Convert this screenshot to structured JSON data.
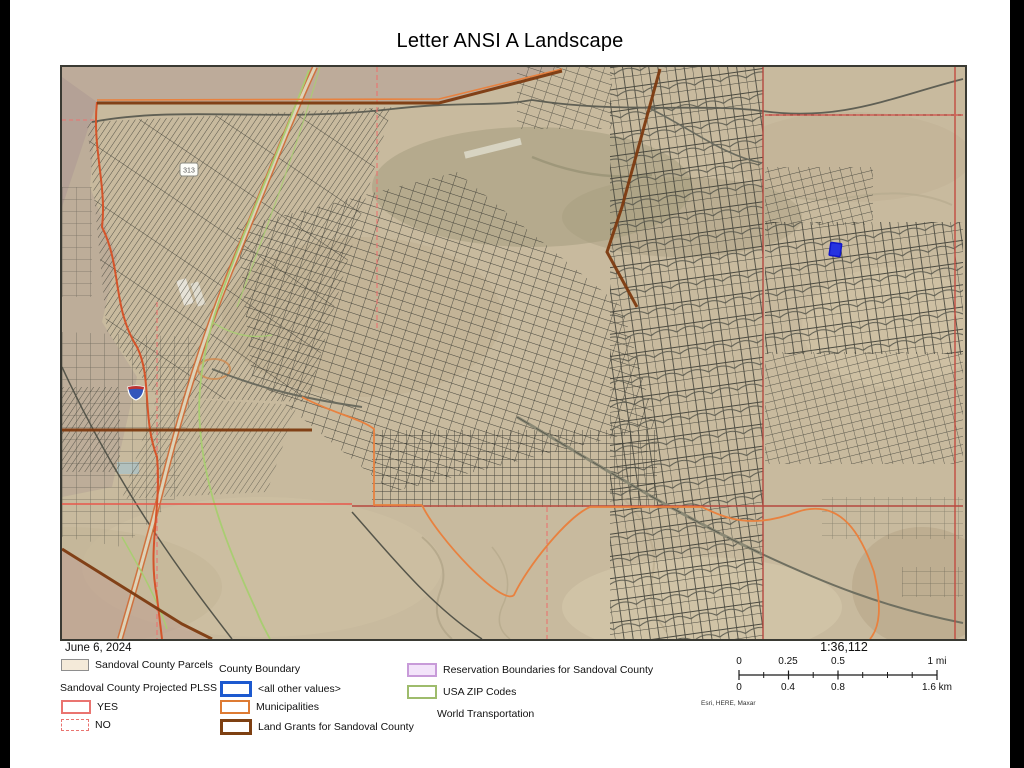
{
  "title": "Letter ANSI A Landscape",
  "map_frame": {
    "date": "June 6, 2024",
    "scale_ratio": "1:36,112",
    "attribution": "Esri, HERE, Maxar",
    "route_shield": "313",
    "highlight_parcel_color": "#2633e0",
    "base_terrain_color": "#c8ba9e"
  },
  "scalebar": {
    "mi": [
      "0",
      "0.25",
      "0.5",
      "1 mi"
    ],
    "km": [
      "0",
      "0.4",
      "0.8",
      "1.6 km"
    ]
  },
  "legend": {
    "col1": {
      "parcels": {
        "label": "Sandoval County Parcels",
        "fill": "#f4ead9",
        "border": "#8e8e8e"
      },
      "plss_heading": "Sandoval County Projected PLSS",
      "yes": {
        "label": "YES",
        "border": "#ea7470"
      },
      "no": {
        "label": "NO",
        "border": "#ea7470"
      }
    },
    "col2": {
      "heading": "County Boundary",
      "all_other": {
        "label": "<all other values>",
        "border": "#1c59cf"
      },
      "municipalities": {
        "label": "Municipalities",
        "border": "#de7b33"
      },
      "land_grants": {
        "label": "Land Grants for Sandoval County",
        "border": "#7e4012"
      }
    },
    "col3": {
      "reservation": {
        "label": "Reservation Boundaries for Sandoval County",
        "fill": "#f3e4fa",
        "border": "#c89bd9"
      },
      "zip": {
        "label": "USA ZIP Codes",
        "border": "#9ebc6c"
      },
      "world_transport_heading": "World Transportation"
    }
  }
}
